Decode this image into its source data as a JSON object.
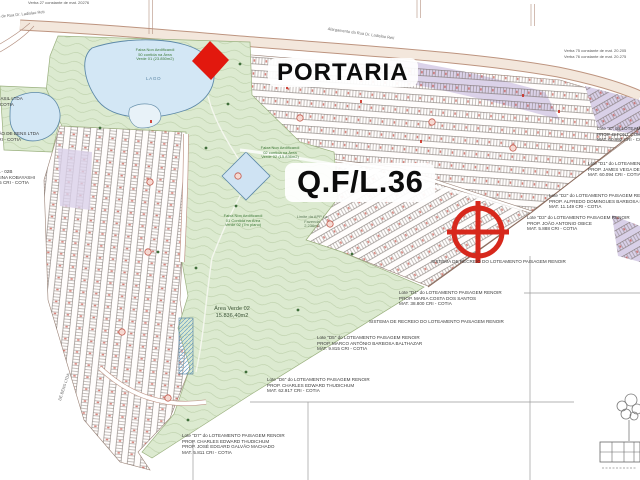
{
  "map_title_labels": {
    "portaria": "PORTARIA",
    "quadra_lote": "Q.F/L.36"
  },
  "green_area_label": {
    "name": "Área Verde 02",
    "area": "15.836,40m2"
  },
  "lake_label": "LAGO",
  "top_notes": {
    "verba_left": "Verba 27 constante de mat. 20276",
    "verba_right_1": "Verba 75 constante de mat. 20.205",
    "verba_right_2": "Verba 76 constante de mat. 20.275",
    "road_top": "Alargamento da Rua Dr. Ladislao Reti",
    "road_left": "alargamento de Rua Dr. Ladislao Reti"
  },
  "faixa_notes": [
    {
      "text": "Faixa Non Aedificandi 50 contida na Área Verde 01 (23.850m2)"
    },
    {
      "text": "Faixa Non Aedificandi 02 contida na Área Verde 02 (15.836m2)"
    },
    {
      "text": "Faixa Non Aedificandi 01 Contida na Área Verde 02 (7m plano)"
    },
    {
      "text": "Limite da APP La Fazenda 2.236m2"
    }
  ],
  "annotations": [
    {
      "id": "lote-c",
      "lines": [
        "Lote \"C\" do LOTEAMENTO PAISAGEM RENOIR",
        "PROP. DIFONT COM. E PART. LTDA",
        "MAT. 60.992   CRI - COTIA"
      ]
    },
    {
      "id": "lote-d1",
      "lines": [
        "Lote \"D1\" do LOTEAMENTO PAISAGEM RENOIR",
        "PROP. JAMES VEGA DE OLIVEIRA",
        "MAT. 60.094   CRI - COTIA"
      ]
    },
    {
      "id": "lote-d2",
      "lines": [
        "Lote \"D2\" do LOTEAMENTO PAISAGEM RENOIR",
        "PROP. ALFREDO DOMINGUES BARBOSA MIGUEL",
        "MAT. 11.149   CRI - COTIA"
      ]
    },
    {
      "id": "lote-d3",
      "lines": [
        "Lote \"D3\" do LOTEAMENTO PAISAGEM RENOIR",
        "PROP. JOÃO ANTONIO OBICE",
        "MAT. 5.888   CRI - COTIA"
      ]
    },
    {
      "id": "sistema-1",
      "lines": [
        "SISTEMA DE RECREIO DO LOTEAMENTO PAISAGEM RENOIR"
      ]
    },
    {
      "id": "lote-d4",
      "lines": [
        "Lote \"D4\" do LOTEAMENTO PAISAGEM RENOIR",
        "PROP. MARIA COSTA DOS SANTOS",
        "MAT. 38.800   CRI - COTIA"
      ]
    },
    {
      "id": "sistema-2",
      "lines": [
        "SISTEMA DE RECREIO DO LOTEAMENTO PAISAGEM RENOIR"
      ]
    },
    {
      "id": "lote-d5",
      "lines": [
        "Lote \"D5\" do LOTEAMENTO PAISAGEM RENOIR",
        "PROP. MARCO ANTÔNIO BARBOSA BALTHAZAR",
        "MAT. 9.815   CRI - COTIA"
      ]
    },
    {
      "id": "lote-d6",
      "lines": [
        "Lote \"D6\" do LOTEAMENTO PAISAGEM RENOIR",
        "PROP. CHARLES EDWARD THUDICHUM",
        "MAT. 62.917   CRI - COTIA"
      ]
    },
    {
      "id": "lote-d7",
      "lines": [
        "Lote \"D7\" do LOTEAMENTO PAISAGEM RENOIR",
        "PROP. CHARLES EDWARD THUDICHUM",
        "PROP. JOSÉ EDGARD GALVÃO MACHADO",
        "MAT. 5.811   CRI - COTIA"
      ]
    }
  ],
  "left_edge_texts": [
    {
      "lines": [
        "RASIL LTDA",
        "- COTIA"
      ]
    },
    {
      "lines": [
        "ÇÃO DE BENS LTDA",
        "CRI - COTIA"
      ]
    },
    {
      "lines": [
        "DA - 02B",
        "USINA KOBAYASHI",
        "005   CRI - COTIA"
      ]
    }
  ],
  "rotated_left_text": "DE BENS LTDA",
  "colors": {
    "marker_red": "#d7281c",
    "diamond_red": "#e2180e",
    "lake_blue": "#d3e7f5",
    "green_area": "#dcead0",
    "purple_lots": "#d9d0e8",
    "road_tan": "#f3e7dc"
  }
}
